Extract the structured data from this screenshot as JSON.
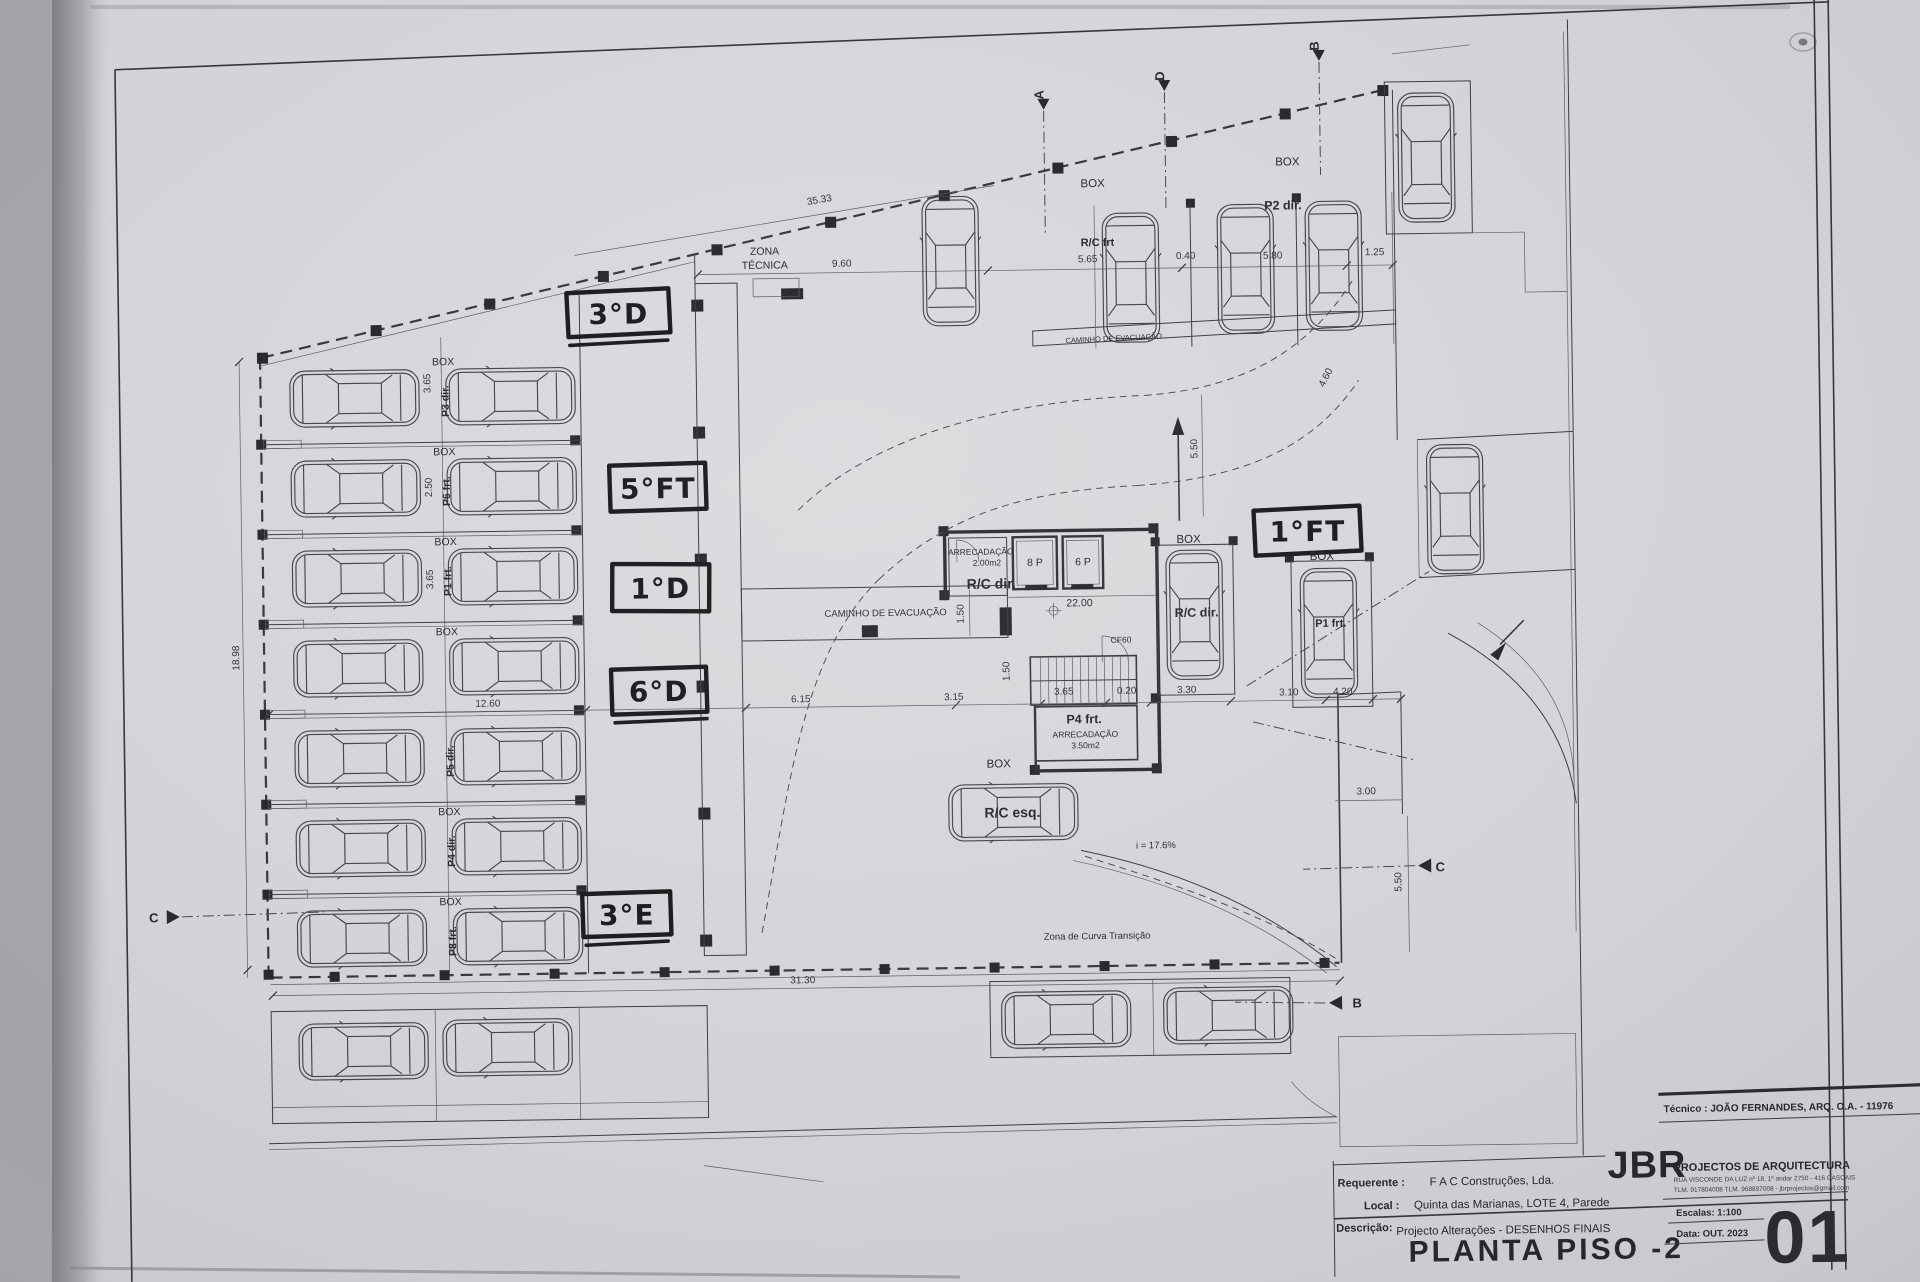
{
  "sheet": {
    "drawing_title": "PLANTA PISO -2",
    "sheet_number": "01",
    "scale_label": "Escalas: 1:100",
    "date_label": "Data: OUT. 2023",
    "tecnico_line": "Técnico : JOÃO FERNANDES, ARQ.   O.A. - 11976",
    "firm_name": "JBR",
    "firm_tagline": "PROJECTOS DE ARQUITECTURA",
    "firm_address": "RUA VISCONDE DA LUZ nº 18, 1º andar  2750 - 416  CASCAIS",
    "firm_contacts": "TLM. 917804008  TLM. 968897008  -  jbrprojectos@gmail.com",
    "requerente_label": "Requerente :",
    "requerente_value": "F A C  Construções, Lda.",
    "local_label": "Local :",
    "local_value": "Quinta das Marianas, LOTE 4, Parede",
    "descricao_label": "Descrição:",
    "descricao_value": "Projecto Alterações - DESENHOS FINAIS"
  },
  "handwritten_annotations": [
    "3°D",
    "5°FT",
    "1°D",
    "6°D",
    "3°E",
    "1°FT"
  ],
  "section_markers": [
    "A",
    "D",
    "B",
    "C",
    "C",
    "B"
  ],
  "parking_rows": [
    {
      "box": "BOX",
      "stall": "P3 dir."
    },
    {
      "box": "BOX",
      "stall": "P6 frt."
    },
    {
      "box": "BOX",
      "stall": "P1 frt."
    },
    {
      "box": "BOX",
      "stall": ""
    },
    {
      "box": "",
      "stall": "P5 dir."
    },
    {
      "box": "BOX",
      "stall": "P4 dir."
    },
    {
      "box": "BOX",
      "stall": "P8 frt."
    }
  ],
  "plan_labels": [
    {
      "text": "ZONA",
      "x": 770,
      "y": 252,
      "cls": "s10"
    },
    {
      "text": "TÉCNICA",
      "x": 770,
      "y": 266,
      "cls": "s10"
    },
    {
      "text": "CAMINHO  DE  EVACUAÇÃO",
      "x": 1118,
      "y": 343,
      "cls": "s7",
      "r": -2
    },
    {
      "text": "CAMINHO  DE  EVACUAÇÃO",
      "x": 886,
      "y": 615,
      "cls": "s9"
    },
    {
      "text": "ARRECADAÇÃO",
      "x": 982,
      "y": 555,
      "cls": "s8"
    },
    {
      "text": "2.00m2",
      "x": 988,
      "y": 566,
      "cls": "s8"
    },
    {
      "text": "R/C dir.",
      "x": 992,
      "y": 589,
      "cls": "b13"
    },
    {
      "text": "8 P",
      "x": 1036,
      "y": 567,
      "cls": "s10"
    },
    {
      "text": "6 P",
      "x": 1084,
      "y": 567,
      "cls": "s10"
    },
    {
      "text": "22.00",
      "x": 1080,
      "y": 608,
      "cls": "s10"
    },
    {
      "text": "CF60",
      "x": 1121,
      "y": 645,
      "cls": "s8"
    },
    {
      "text": "P4 frt.",
      "x": 1083,
      "y": 725,
      "cls": "b12"
    },
    {
      "text": "ARRECADAÇÃO",
      "x": 1084,
      "y": 739,
      "cls": "s8"
    },
    {
      "text": "3.50m2",
      "x": 1084,
      "y": 750,
      "cls": "s8"
    },
    {
      "text": "BOX",
      "x": 997,
      "y": 768,
      "cls": "s11"
    },
    {
      "text": "R/C esq.",
      "x": 1010,
      "y": 818,
      "cls": "b13"
    },
    {
      "text": "i = 17.6%",
      "x": 1153,
      "y": 851,
      "cls": "s9"
    },
    {
      "text": "Zona de Curva Transição",
      "x": 1093,
      "y": 941,
      "cls": "s9"
    },
    {
      "text": "BOX",
      "x": 1099,
      "y": 189,
      "cls": "s11"
    },
    {
      "text": "R/C frt",
      "x": 1103,
      "y": 248,
      "cls": "b11"
    },
    {
      "text": "BOX",
      "x": 1294,
      "y": 170,
      "cls": "s11"
    },
    {
      "text": "P2 dir.",
      "x": 1289,
      "y": 214,
      "cls": "b12"
    },
    {
      "text": "BOX",
      "x": 1190,
      "y": 546,
      "cls": "s11"
    },
    {
      "text": "R/C dir.",
      "x": 1197,
      "y": 620,
      "cls": "b12"
    },
    {
      "text": "BOX",
      "x": 1323,
      "y": 565,
      "cls": "s11"
    },
    {
      "text": "P1 frt.",
      "x": 1331,
      "y": 632,
      "cls": "b11"
    }
  ],
  "dimensions": [
    {
      "value": "35.33",
      "x": 826,
      "y": 201,
      "r": -9
    },
    {
      "value": "9.60",
      "x": 847,
      "y": 265
    },
    {
      "value": "5.65",
      "x": 1093,
      "y": 264
    },
    {
      "value": "0.40",
      "x": 1191,
      "y": 262
    },
    {
      "value": "5.80",
      "x": 1278,
      "y": 263
    },
    {
      "value": "1.25",
      "x": 1380,
      "y": 261
    },
    {
      "value": "18.98",
      "x": 239,
      "y": 648,
      "r": -90
    },
    {
      "value": "3.65",
      "x": 434,
      "y": 376,
      "r": -90
    },
    {
      "value": "2.50",
      "x": 434,
      "y": 480,
      "r": -90
    },
    {
      "value": "3.65",
      "x": 434,
      "y": 572,
      "r": -90
    },
    {
      "value": "12.60",
      "x": 487,
      "y": 700
    },
    {
      "value": "6.15",
      "x": 800,
      "y": 700
    },
    {
      "value": "3.15",
      "x": 953,
      "y": 700
    },
    {
      "value": "3.65",
      "x": 1063,
      "y": 696
    },
    {
      "value": "0.20",
      "x": 1126,
      "y": 696
    },
    {
      "value": "3.30",
      "x": 1186,
      "y": 696
    },
    {
      "value": "3.10",
      "x": 1288,
      "y": 700
    },
    {
      "value": "4.20",
      "x": 1342,
      "y": 700
    },
    {
      "value": "3.00",
      "x": 1364,
      "y": 800
    },
    {
      "value": "5.50",
      "x": 1398,
      "y": 888,
      "r": -90
    },
    {
      "value": "5.50",
      "x": 1200,
      "y": 452,
      "r": -90
    },
    {
      "value": "4.60",
      "x": 1332,
      "y": 384,
      "r": -62
    },
    {
      "value": "1.50",
      "x": 964,
      "y": 614,
      "r": -90
    },
    {
      "value": "1.50",
      "x": 1009,
      "y": 672,
      "r": -90
    },
    {
      "value": "31.30",
      "x": 798,
      "y": 981
    }
  ],
  "colors": {
    "paper": "#d2d3d7",
    "ink": "#2e2f36",
    "marker": "#17181b"
  }
}
